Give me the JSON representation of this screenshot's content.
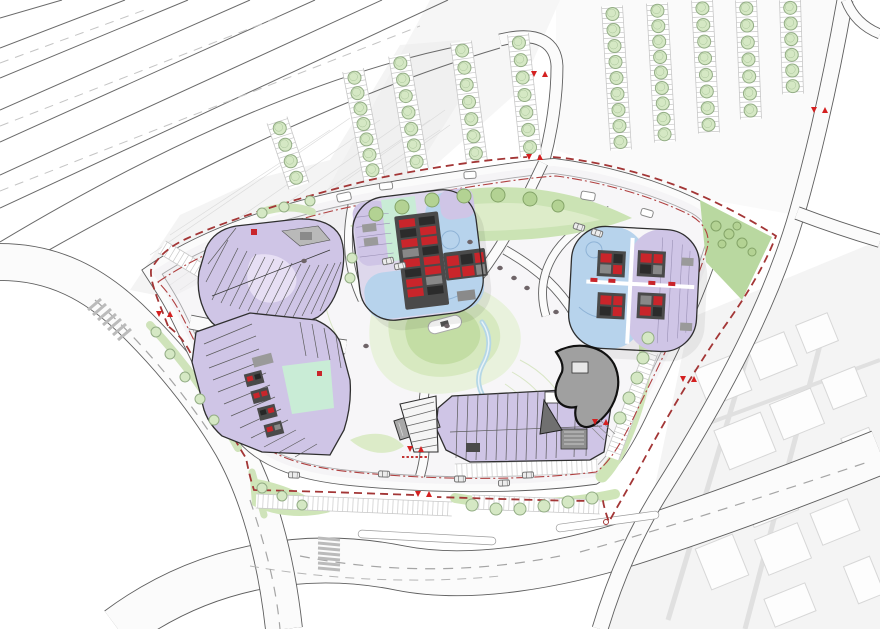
{
  "plan": {
    "kind": "architectural-masterplan-site-plan",
    "visible_text": [],
    "entry_marker_glyphs": [
      "down-triangle-icon",
      "up-triangle-icon"
    ]
  },
  "palette": {
    "purple": "#cfc5e6",
    "purple_light": "#e7dff4",
    "blue": "#b7d3ec",
    "mint": "#c9ecd6",
    "core_dark": "#4a4a4a",
    "unit_red": "#c9252b",
    "marker_red": "#d42020",
    "boundary_red": "#a33636",
    "setback_red": "#b04040",
    "tree_fill": "#d5e8c4",
    "tree_stroke": "#93ad85",
    "tree_dark_fill": "#b3d293",
    "tree_dark_stroke": "#84a468",
    "green_band": "#cfe5b8",
    "park_light": "#e9f2dd",
    "park_mid": "#d7e9c0",
    "park_core": "#c3dda4",
    "stream_blue": "#b5d7e6",
    "gray_building": "#a0a0a0",
    "road_edge": "#5f5f5f",
    "plaza": "#efeef1"
  },
  "markers": [
    [
      540,
      74
    ],
    [
      535,
      157
    ],
    [
      820,
      110
    ],
    [
      165,
      314
    ],
    [
      424,
      494
    ],
    [
      416,
      449
    ],
    [
      601,
      422
    ],
    [
      689,
      379
    ]
  ],
  "parking_rows": [
    [
      277,
      120,
      299,
      186,
      4
    ],
    [
      353,
      70,
      374,
      178,
      7
    ],
    [
      399,
      55,
      418,
      170,
      7
    ],
    [
      461,
      42,
      477,
      162,
      7
    ],
    [
      518,
      34,
      531,
      156,
      7
    ],
    [
      612,
      6,
      621,
      150,
      9
    ],
    [
      657,
      3,
      665,
      142,
      9
    ],
    [
      702,
      0,
      709,
      133,
      8
    ],
    [
      746,
      0,
      751,
      119,
      7
    ],
    [
      790,
      0,
      793,
      94,
      6
    ]
  ],
  "stall_strips": [
    [
      256,
      501,
      452,
      509
    ],
    [
      472,
      502,
      600,
      507
    ],
    [
      651,
      352,
      612,
      458
    ],
    [
      162,
      247,
      228,
      287
    ],
    [
      455,
      471,
      598,
      466
    ]
  ],
  "scatter_trees": [
    [
      376,
      214,
      7,
      "d"
    ],
    [
      402,
      207,
      7,
      "d"
    ],
    [
      432,
      200,
      7,
      "d"
    ],
    [
      464,
      196,
      7,
      "d"
    ],
    [
      498,
      195,
      7,
      "d"
    ],
    [
      530,
      199,
      7,
      "d"
    ],
    [
      558,
      206,
      6,
      "d"
    ],
    [
      716,
      226,
      5,
      "d"
    ],
    [
      729,
      234,
      5,
      "d"
    ],
    [
      742,
      243,
      5,
      "d"
    ],
    [
      752,
      252,
      4,
      "d"
    ],
    [
      722,
      244,
      4,
      "d"
    ],
    [
      737,
      226,
      4,
      "d"
    ],
    [
      648,
      338,
      6,
      "l"
    ],
    [
      643,
      358,
      6,
      "l"
    ],
    [
      637,
      378,
      6,
      "l"
    ],
    [
      629,
      398,
      6,
      "l"
    ],
    [
      620,
      418,
      6,
      "l"
    ],
    [
      472,
      505,
      6,
      "l"
    ],
    [
      496,
      509,
      6,
      "l"
    ],
    [
      520,
      509,
      6,
      "l"
    ],
    [
      544,
      506,
      6,
      "l"
    ],
    [
      568,
      502,
      6,
      "l"
    ],
    [
      592,
      498,
      6,
      "l"
    ],
    [
      156,
      332,
      5,
      "l"
    ],
    [
      170,
      354,
      5,
      "l"
    ],
    [
      185,
      377,
      5,
      "l"
    ],
    [
      200,
      399,
      5,
      "l"
    ],
    [
      214,
      420,
      5,
      "l"
    ],
    [
      262,
      488,
      5,
      "l"
    ],
    [
      282,
      496,
      5,
      "l"
    ],
    [
      302,
      505,
      5,
      "l"
    ],
    [
      262,
      213,
      5,
      "l"
    ],
    [
      284,
      207,
      5,
      "l"
    ],
    [
      310,
      201,
      5,
      "l"
    ],
    [
      352,
      258,
      5,
      "l"
    ],
    [
      350,
      278,
      5,
      "l"
    ]
  ],
  "cars": [
    [
      388,
      261,
      -12
    ],
    [
      400,
      266,
      -12
    ],
    [
      579,
      227,
      18
    ],
    [
      597,
      233,
      18
    ],
    [
      294,
      475,
      3
    ],
    [
      384,
      474,
      2
    ],
    [
      504,
      483,
      -2
    ],
    [
      528,
      475,
      -2
    ],
    [
      460,
      479,
      0
    ]
  ],
  "kiosks": [
    [
      344,
      197,
      14,
      8,
      -12
    ],
    [
      386,
      186,
      13,
      7,
      -6
    ],
    [
      470,
      175,
      12,
      7,
      -3
    ],
    [
      588,
      196,
      14,
      8,
      10
    ],
    [
      647,
      213,
      12,
      7,
      16
    ]
  ],
  "plaza_dots": [
    [
      500,
      268
    ],
    [
      514,
      278
    ],
    [
      527,
      288
    ],
    [
      470,
      242
    ],
    [
      447,
      326
    ],
    [
      556,
      312
    ],
    [
      304,
      261
    ],
    [
      366,
      346
    ]
  ],
  "city_blocks": [
    [
      700,
      360,
      46,
      40
    ],
    [
      752,
      338,
      40,
      36
    ],
    [
      800,
      318,
      34,
      30
    ],
    [
      720,
      420,
      50,
      42
    ],
    [
      775,
      395,
      44,
      38
    ],
    [
      826,
      372,
      36,
      32
    ],
    [
      745,
      480,
      48,
      40
    ],
    [
      798,
      455,
      42,
      36
    ],
    [
      845,
      432,
      30,
      28
    ],
    [
      702,
      540,
      40,
      44
    ],
    [
      760,
      530,
      46,
      38
    ],
    [
      815,
      505,
      40,
      34
    ],
    [
      850,
      560,
      28,
      40
    ],
    [
      768,
      590,
      44,
      30
    ]
  ],
  "city_block_angle": -22,
  "highway": {
    "solid": [
      [
        0,
        18,
        62,
        0
      ],
      [
        0,
        48,
        125,
        0
      ],
      [
        0,
        78,
        188,
        0
      ],
      [
        0,
        110,
        250,
        0
      ],
      [
        0,
        142,
        315,
        0
      ],
      [
        0,
        175,
        382,
        0
      ],
      [
        0,
        208,
        448,
        0
      ]
    ],
    "dashed": [
      [
        0,
        63,
        150,
        8
      ],
      [
        0,
        126,
        282,
        16
      ],
      [
        0,
        191,
        420,
        26
      ]
    ]
  },
  "buildings": [
    {
      "id": "retail-block-northwest",
      "shape": "subdivided-strip-block",
      "fill_key": "purple"
    },
    {
      "id": "retail-block-southwest",
      "shape": "subdivided-strip-block-with-mint-court",
      "fill_key": "purple"
    },
    {
      "id": "office-tower-center",
      "shape": "rounded-square-tower",
      "fill_keys": [
        "blue",
        "purple",
        "mint",
        "core_dark",
        "unit_red"
      ]
    },
    {
      "id": "office-tower-east",
      "shape": "rounded-square-tower",
      "fill_keys": [
        "blue",
        "purple",
        "core_dark",
        "unit_red"
      ]
    },
    {
      "id": "retail-strip-south",
      "shape": "subdivided-strip-block",
      "fill_key": "purple"
    },
    {
      "id": "pavilion-gray-organic",
      "shape": "organic-blob",
      "fill_key": "gray_building"
    }
  ]
}
